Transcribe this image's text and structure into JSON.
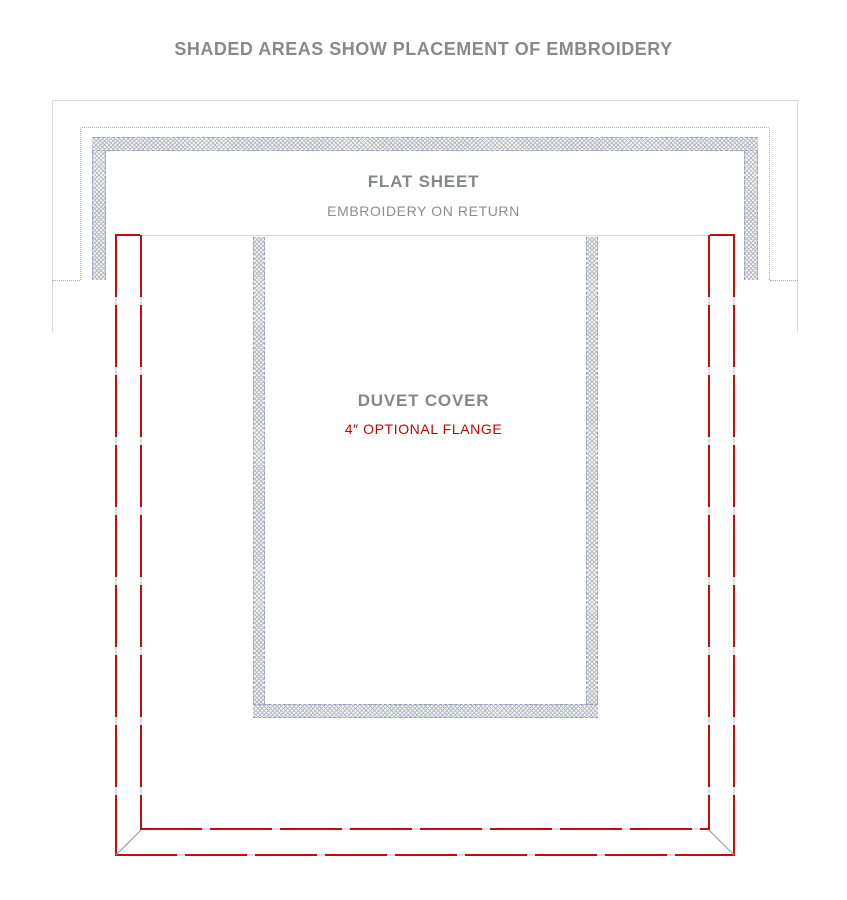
{
  "title": "SHADED AREAS SHOW PLACEMENT OF EMBROIDERY",
  "flat_sheet": {
    "label": "FLAT SHEET",
    "sublabel": "EMBROIDERY ON RETURN"
  },
  "duvet": {
    "label": "DUVET COVER",
    "sublabel": "4″ OPTIONAL FLANGE"
  },
  "colors": {
    "text_gray": "#87898c",
    "accent_red": "#c30d0d",
    "sheet_outline_gray": "#d8d9db",
    "fold_dotted_gray": "#aab0b6",
    "embroidery_dash_blue": "#94a2c6",
    "hatch_gray": "#b9bdc3",
    "duvet_top_edge_gray": "#d4d6d8",
    "miter_gray": "#9aa0a5"
  }
}
